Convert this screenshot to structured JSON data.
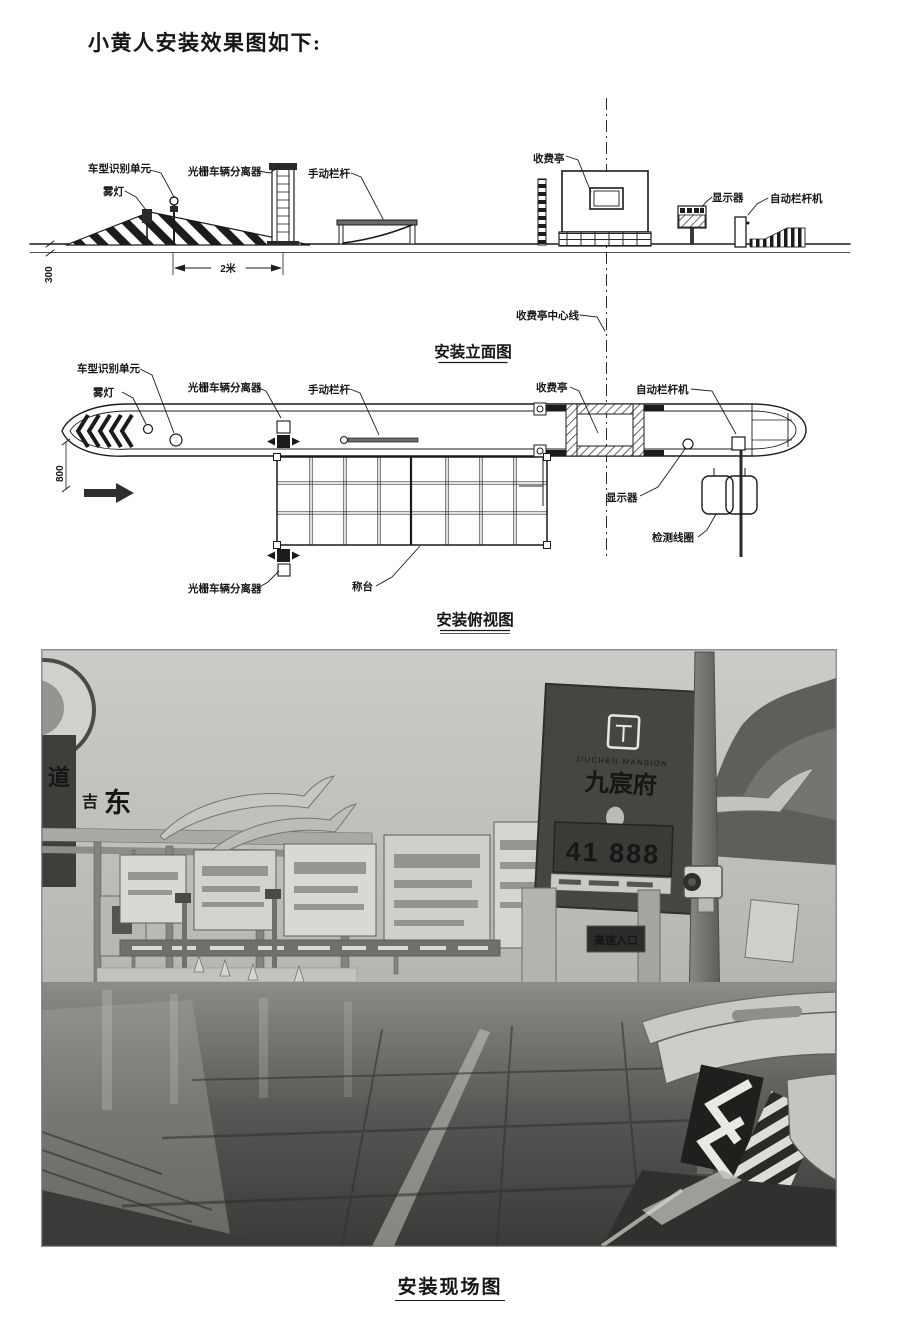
{
  "page": {
    "title": "小黄人安装效果图如下:"
  },
  "elevation": {
    "caption": "安装立面图",
    "labels": {
      "vehicle_type_unit": "车型识别单元",
      "fog_light": "雾灯",
      "grating_separator": "光栅车辆分离器",
      "manual_barrier": "手动栏杆",
      "toll_booth": "收费亭",
      "display": "显示器",
      "auto_barrier_machine": "自动栏杆机",
      "booth_centerline": "收费亭中心线"
    },
    "dimensions": {
      "island_height": "300",
      "unit_spacing": "2米"
    }
  },
  "plan": {
    "caption": "安装俯视图",
    "labels": {
      "vehicle_type_unit": "车型识别单元",
      "fog_light": "雾灯",
      "grating_separator_entry": "光栅车辆分离器",
      "manual_barrier": "手动栏杆",
      "toll_booth": "收费亭",
      "auto_barrier_machine": "自动栏杆机",
      "display": "显示器",
      "detection_coil": "检测线圈",
      "weighbridge": "称台",
      "grating_separator_exit": "光栅车辆分离器"
    },
    "dimensions": {
      "island_width": "800"
    }
  },
  "photo": {
    "caption": "安装现场图",
    "signs": {
      "left_banner_char": "道",
      "gantry_char_1": "吉",
      "gantry_char_2": "东",
      "billboard_name_cn": "九宸府",
      "billboard_name_en": "JIUCHEN·MANSION",
      "price_sign": "41 888",
      "entrance_sign": "高速入口"
    }
  },
  "colors": {
    "ink": "#1b1b1b",
    "paper": "#ffffff",
    "photo_sky": "#c6c6c3",
    "photo_dark": "#3c3c39"
  }
}
